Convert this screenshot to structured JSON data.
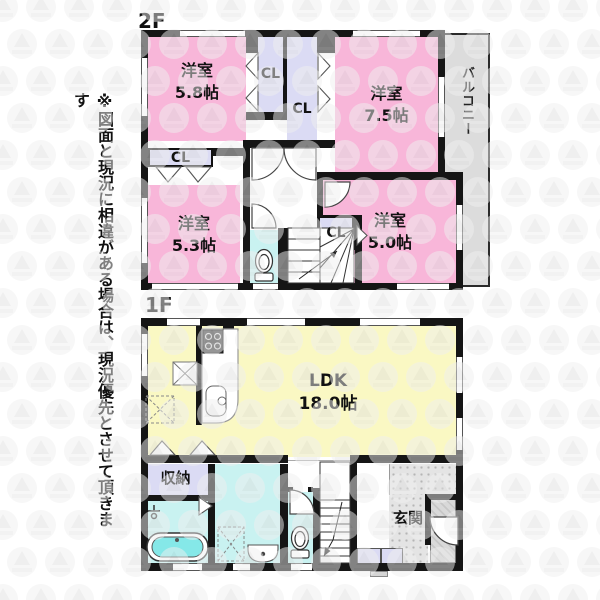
{
  "disclaimer": "※図面と現況に相違がある場合は、現況優先とさせて頂きます",
  "floors": {
    "f2": {
      "label": "2F",
      "room_58": {
        "name": "洋室",
        "size": "5.8帖"
      },
      "room_75": {
        "name": "洋室",
        "size": "7.5帖"
      },
      "room_53": {
        "name": "洋室",
        "size": "5.3帖"
      },
      "room_50": {
        "name": "洋室",
        "size": "5.0帖"
      },
      "closet": "CL",
      "balcony": "バルコニー"
    },
    "f1": {
      "label": "1F",
      "ldk": {
        "name": "LDK",
        "size": "18.0帖"
      },
      "storage": "収納",
      "entrance": "玄関"
    }
  },
  "colors": {
    "wall": "#151515",
    "pink": "#F8B6D9",
    "lavender": "#DBDBF4",
    "cyan": "#C9F2F1",
    "tub": "#85E8E8",
    "yellow": "#FAF8C3",
    "balcony": "#DCDCDC",
    "entrance_floor": "#E4E4E4",
    "porch": "#D9D9D9"
  }
}
